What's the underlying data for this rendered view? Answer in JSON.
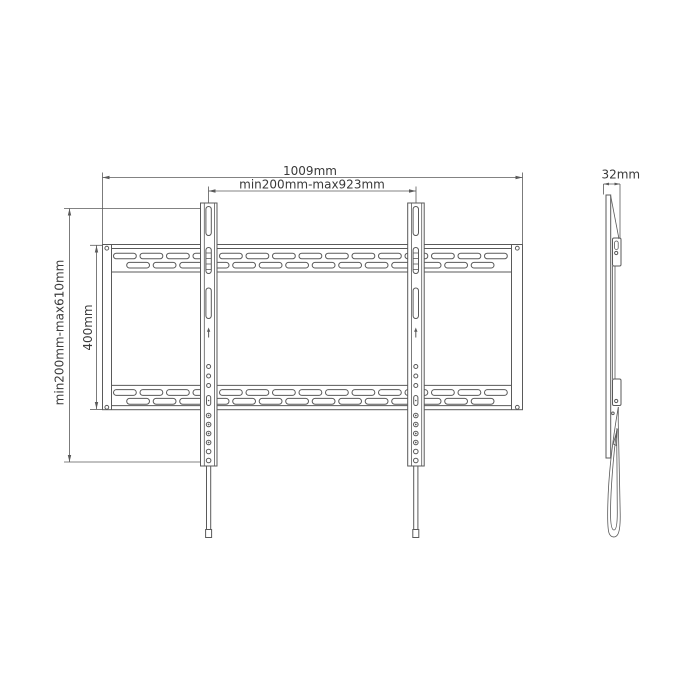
{
  "dimensions": {
    "overall_width": "1009mm",
    "mount_width_range": "min200mm-max923mm",
    "mount_height_range": "min200mm-max610mm",
    "plate_height": "400mm",
    "depth": "32mm"
  },
  "colors": {
    "line": "#5a5a5a",
    "text": "#3a3a3a",
    "background": "#ffffff"
  }
}
